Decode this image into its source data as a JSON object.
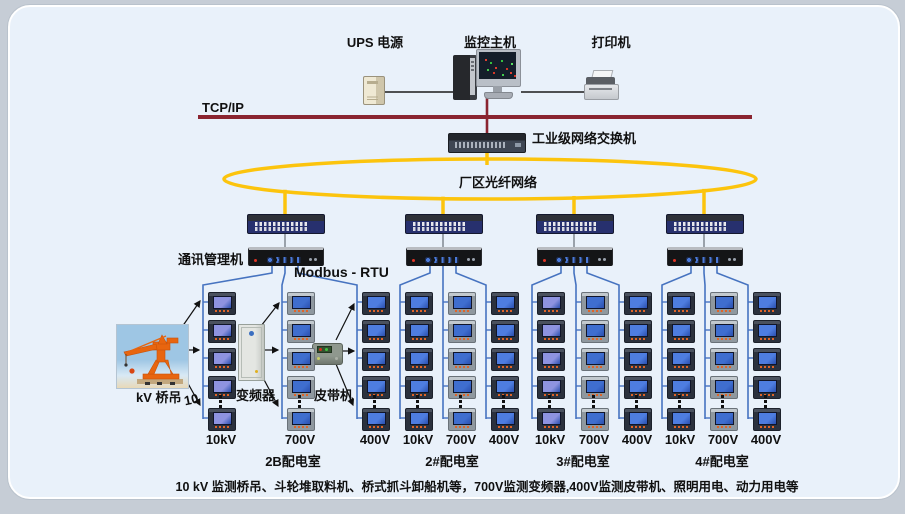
{
  "top": {
    "ups_label": "UPS 电源",
    "host_label": "监控主机",
    "printer_label": "打印机"
  },
  "network": {
    "tcpip_label": "TCP/IP",
    "industrial_switch_label": "工业级网络交换机",
    "fiber_ring_label": "厂区光纤网络",
    "comm_manager_label": "通讯管理机",
    "modbus_label": "Modbus - RTU"
  },
  "equipment": {
    "crane_label_prefix": "10",
    "crane_label": "kV 桥吊",
    "vfd_label": "变频器",
    "belt_label": "皮带机"
  },
  "groups": [
    {
      "room": "2B配电室",
      "voltages": [
        "10kV",
        "700V",
        "400V"
      ]
    },
    {
      "room": "2#配电室",
      "voltages": [
        "10kV",
        "700V",
        "400V"
      ]
    },
    {
      "room": "3#配电室",
      "voltages": [
        "10kV",
        "700V",
        "400V"
      ]
    },
    {
      "room": "4#配电室",
      "voltages": [
        "10kV",
        "700V",
        "400V"
      ]
    }
  ],
  "footnote": "10 kV 监测桥吊、斗轮堆取料机、桥式抓斗卸船机等，700V监测变频器,400V监测皮带机、照明用电、动力用电等",
  "colors": {
    "tcp_bus": "#8a2430",
    "fiber_yellow": "#fcc40d",
    "rs485_blue": "#4673c0",
    "panel_bg": "#e9f1fa"
  }
}
